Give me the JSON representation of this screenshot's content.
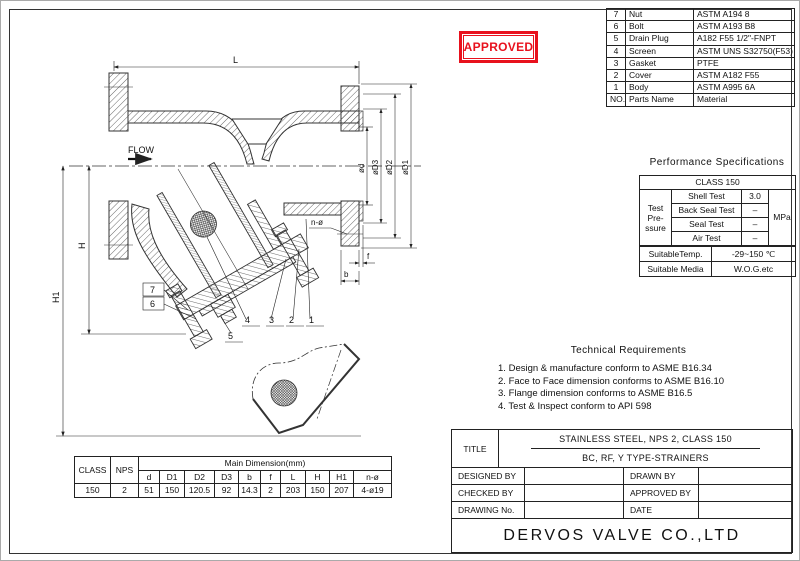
{
  "stamp": {
    "text": "APPROVED",
    "color": "#e8111d"
  },
  "parts_table": {
    "rows": [
      {
        "no": "7",
        "name": "Nut",
        "material": "ASTM A194 8"
      },
      {
        "no": "6",
        "name": "Bolt",
        "material": "ASTM A193 B8"
      },
      {
        "no": "5",
        "name": "Drain Plug",
        "material": "A182 F55 1/2\"-FNPT"
      },
      {
        "no": "4",
        "name": "Screen",
        "material": "ASTM UNS S32750(F53)"
      },
      {
        "no": "3",
        "name": "Gasket",
        "material": "PTFE"
      },
      {
        "no": "2",
        "name": "Cover",
        "material": "ASTM A182 F55"
      },
      {
        "no": "1",
        "name": "Body",
        "material": "ASTM A995 6A"
      }
    ],
    "footer": {
      "no": "NO.",
      "name": "Parts Name",
      "material": "Material"
    }
  },
  "performance": {
    "title": "Performance Specifications",
    "class_header": "CLASS 150",
    "group_label": "Test Pre- ssure",
    "tests": [
      {
        "name": "Shell Test",
        "value": "3.0"
      },
      {
        "name": "Back Seal Test",
        "value": "–"
      },
      {
        "name": "Seal Test",
        "value": "–"
      },
      {
        "name": "Air Test",
        "value": "–"
      }
    ],
    "unit": "MPa",
    "temp_label": "SuitableTemp.",
    "temp_value": "-29~150 ℃",
    "media_label": "Suitable Media",
    "media_value": "W.O.G.etc"
  },
  "technical": {
    "title": "Technical Requirements",
    "items": [
      {
        "num": "1.",
        "text": "Design & manufacture conform to ASME B16.34"
      },
      {
        "num": "2.",
        "text": "Face to Face dimension conforms to ASME B16.10"
      },
      {
        "num": "3.",
        "text": "Flange dimension conforms to ASME B16.5"
      },
      {
        "num": "4.",
        "text": "Test & Inspect conform to API 598"
      }
    ]
  },
  "dim_table": {
    "class_label": "CLASS",
    "nps_label": "NPS",
    "span_header": "Main Dimension(mm)",
    "cols": [
      "d",
      "D1",
      "D2",
      "D3",
      "b",
      "f",
      "L",
      "H",
      "H1",
      "n-ø"
    ],
    "class_value": "150",
    "nps_value": "2",
    "values": [
      "51",
      "150",
      "120.5",
      "92",
      "14.3",
      "2",
      "203",
      "150",
      "207",
      "4-ø19"
    ]
  },
  "title_block": {
    "title_label": "TITLE",
    "title_line1": "STAINLESS STEEL, NPS 2, CLASS 150",
    "title_line2": "BC, RF, Y TYPE-STRAINERS",
    "designed": "DESIGNED BY",
    "drawn": "DRAWN BY",
    "checked": "CHECKED BY",
    "approved": "APPROVED BY",
    "drawing_no": "DRAWING No.",
    "date": "DATE",
    "company": "DERVOS VALVE CO.,LTD"
  },
  "drawing": {
    "flow": "FLOW",
    "dims": {
      "L": "L",
      "H": "H",
      "H1": "H1",
      "b": "b",
      "f": "f",
      "n": "n-ø",
      "d": "ød",
      "D3": "øD3",
      "D2": "øD2",
      "D1": "øD1"
    },
    "callouts": [
      "1",
      "2",
      "3",
      "4",
      "5",
      "6",
      "7"
    ]
  }
}
